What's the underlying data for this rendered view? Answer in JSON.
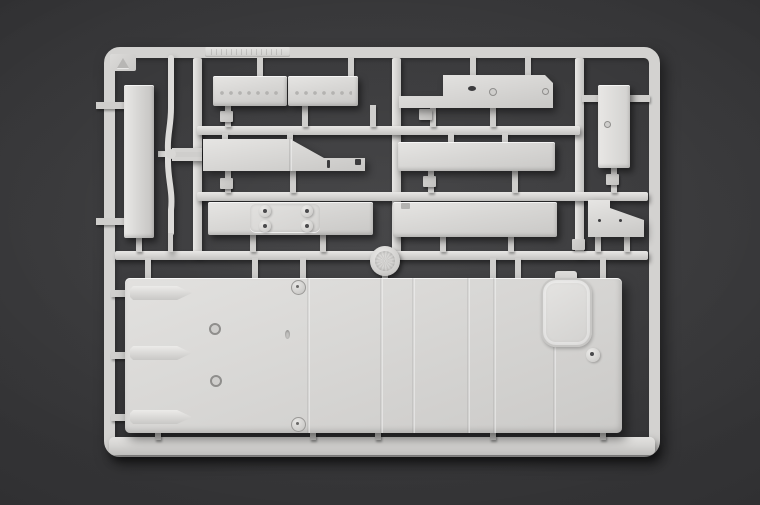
{
  "scene": {
    "type": "photograph",
    "subject": "Light-grey injection-molded plastic model kit sprue (parts frame) on a dark grey backdrop",
    "background_color": "#2e2e30",
    "plastic_color": "#d8d7d5",
    "shadow_color": "#1d1d1f"
  },
  "sprue": {
    "corner_marking": "molded triangle mark",
    "top_rail_marking": "small embossed illegible lettering",
    "parts": [
      {
        "id": "vertical-strip",
        "label": "narrow vertical strip part"
      },
      {
        "id": "curved-rod",
        "label": "thin S-curved rod with cross pins"
      },
      {
        "id": "riveted-plank-left",
        "label": "riveted plank, left"
      },
      {
        "id": "riveted-plank-right",
        "label": "riveted plank, right"
      },
      {
        "id": "stepped-bracket",
        "label": "stepped bracket with holes"
      },
      {
        "id": "tall-block",
        "label": "tall rectangular block with hole"
      },
      {
        "id": "sloped-bracket",
        "label": "sloped bracket with slots"
      },
      {
        "id": "plain-plank-upper",
        "label": "plain rectangular plank"
      },
      {
        "id": "bolted-plate-plank",
        "label": "plank with raised plate and four bolt bosses"
      },
      {
        "id": "plain-plank-lower",
        "label": "plain plank with corner notch"
      },
      {
        "id": "angled-bracket",
        "label": "angled wedge bracket with two holes"
      },
      {
        "id": "mold-medallion",
        "label": "round engraved mold medallion"
      },
      {
        "id": "floor-panel",
        "label": "large ribbed floor panel with oval hatch"
      }
    ],
    "floor_panel_features": [
      "three pointed raised ridges",
      "two small round holes",
      "two round rivets",
      "vertical panel ribs",
      "oval hatch with hinge tab",
      "round boss"
    ]
  }
}
